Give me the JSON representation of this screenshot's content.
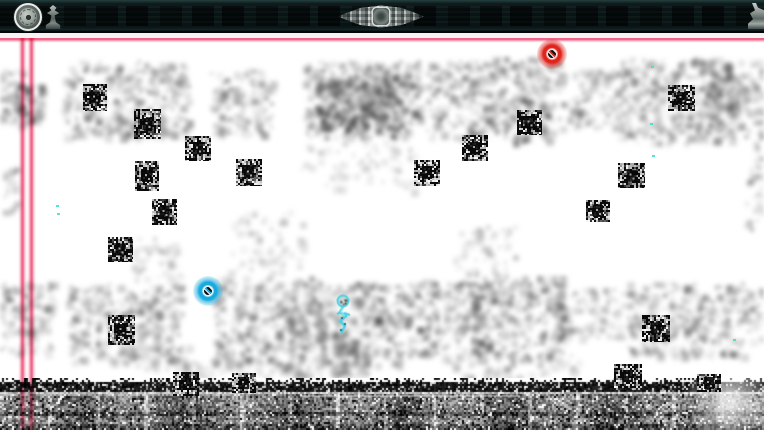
{
  "scene": {
    "kind": "glitch-platformer-level",
    "viewport": {
      "width": 764,
      "height": 430
    },
    "background_color": "#ffffff"
  },
  "hud": {
    "bar_color": "#0a1414",
    "bar_height": 33,
    "icons": [
      {
        "name": "medallion-icon"
      },
      {
        "name": "statuette-icon"
      },
      {
        "name": "center-emblem-icon"
      },
      {
        "name": "right-ornament-icon"
      }
    ]
  },
  "scanlines": {
    "color": "#ee6387",
    "horizontal": {
      "y": 34
    },
    "verticals": [
      {
        "x": 18
      },
      {
        "x": 27
      }
    ]
  },
  "entities": {
    "player": {
      "name": "player-character",
      "x": 331,
      "y": 292,
      "w": 24,
      "h": 44,
      "color": "#4ad0e0"
    },
    "orbs": [
      {
        "name": "red-orb",
        "cx": 552,
        "cy": 54,
        "color": "#e0241c",
        "lite": "#f8d8d4"
      },
      {
        "name": "cyan-orb",
        "cx": 208,
        "cy": 291,
        "color": "#18aadf",
        "lite": "#d8f2fa"
      }
    ],
    "particles": {
      "color": "#38dfc9",
      "points": [
        {
          "x": 651,
          "y": 66
        },
        {
          "x": 650,
          "y": 123
        },
        {
          "x": 652,
          "y": 155
        },
        {
          "x": 56,
          "y": 205
        },
        {
          "x": 57,
          "y": 213
        },
        {
          "x": 733,
          "y": 339
        }
      ]
    }
  },
  "blocks": [
    {
      "x": 83,
      "y": 84,
      "w": 24,
      "h": 27,
      "seed": 11
    },
    {
      "x": 134,
      "y": 109,
      "w": 27,
      "h": 30,
      "seed": 12
    },
    {
      "x": 185,
      "y": 136,
      "w": 26,
      "h": 25,
      "seed": 13
    },
    {
      "x": 135,
      "y": 161,
      "w": 24,
      "h": 30,
      "seed": 14
    },
    {
      "x": 152,
      "y": 199,
      "w": 25,
      "h": 26,
      "seed": 15
    },
    {
      "x": 108,
      "y": 237,
      "w": 25,
      "h": 25,
      "seed": 16
    },
    {
      "x": 236,
      "y": 159,
      "w": 26,
      "h": 27,
      "seed": 17
    },
    {
      "x": 414,
      "y": 160,
      "w": 26,
      "h": 26,
      "seed": 18
    },
    {
      "x": 462,
      "y": 135,
      "w": 26,
      "h": 26,
      "seed": 19
    },
    {
      "x": 517,
      "y": 110,
      "w": 25,
      "h": 25,
      "seed": 20
    },
    {
      "x": 668,
      "y": 85,
      "w": 27,
      "h": 26,
      "seed": 21
    },
    {
      "x": 618,
      "y": 163,
      "w": 27,
      "h": 25,
      "seed": 22
    },
    {
      "x": 586,
      "y": 200,
      "w": 24,
      "h": 22,
      "seed": 23
    },
    {
      "x": 108,
      "y": 315,
      "w": 27,
      "h": 30,
      "seed": 24
    },
    {
      "x": 642,
      "y": 315,
      "w": 28,
      "h": 27,
      "seed": 25
    },
    {
      "x": 173,
      "y": 372,
      "w": 26,
      "h": 24,
      "seed": 26
    },
    {
      "x": 232,
      "y": 373,
      "w": 24,
      "h": 20,
      "seed": 27
    },
    {
      "x": 614,
      "y": 364,
      "w": 28,
      "h": 24,
      "seed": 28
    },
    {
      "x": 697,
      "y": 374,
      "w": 24,
      "h": 18,
      "seed": 29
    }
  ],
  "smoke": [
    {
      "x": 0,
      "y": 68,
      "w": 28,
      "h": 55,
      "d": 0.45
    },
    {
      "x": 14,
      "y": 84,
      "w": 30,
      "h": 40,
      "d": 0.7
    },
    {
      "x": 62,
      "y": 62,
      "w": 125,
      "h": 75,
      "d": 0.5
    },
    {
      "x": 92,
      "y": 118,
      "w": 60,
      "h": 20,
      "d": 0.35
    },
    {
      "x": 212,
      "y": 70,
      "w": 60,
      "h": 65,
      "d": 0.45
    },
    {
      "x": 305,
      "y": 62,
      "w": 115,
      "h": 75,
      "d": 0.62
    },
    {
      "x": 320,
      "y": 74,
      "w": 80,
      "h": 55,
      "d": 0.85
    },
    {
      "x": 428,
      "y": 62,
      "w": 60,
      "h": 75,
      "d": 0.5
    },
    {
      "x": 488,
      "y": 58,
      "w": 75,
      "h": 85,
      "d": 0.55
    },
    {
      "x": 565,
      "y": 68,
      "w": 60,
      "h": 60,
      "d": 0.4
    },
    {
      "x": 620,
      "y": 58,
      "w": 115,
      "h": 85,
      "d": 0.5
    },
    {
      "x": 700,
      "y": 60,
      "w": 64,
      "h": 70,
      "d": 0.45
    },
    {
      "x": 744,
      "y": 130,
      "w": 20,
      "h": 100,
      "d": 0.28
    },
    {
      "x": 0,
      "y": 165,
      "w": 18,
      "h": 50,
      "d": 0.28
    },
    {
      "x": 300,
      "y": 140,
      "w": 120,
      "h": 50,
      "d": 0.14
    },
    {
      "x": 228,
      "y": 212,
      "w": 75,
      "h": 60,
      "d": 0.18
    },
    {
      "x": 455,
      "y": 225,
      "w": 60,
      "h": 80,
      "d": 0.22
    },
    {
      "x": 133,
      "y": 238,
      "w": 45,
      "h": 42,
      "d": 0.3
    },
    {
      "x": 0,
      "y": 282,
      "w": 55,
      "h": 70,
      "d": 0.45
    },
    {
      "x": 68,
      "y": 282,
      "w": 115,
      "h": 80,
      "d": 0.5
    },
    {
      "x": 128,
      "y": 345,
      "w": 60,
      "h": 25,
      "d": 0.32
    },
    {
      "x": 213,
      "y": 278,
      "w": 110,
      "h": 88,
      "d": 0.5
    },
    {
      "x": 320,
      "y": 282,
      "w": 85,
      "h": 85,
      "d": 0.55
    },
    {
      "x": 330,
      "y": 330,
      "w": 40,
      "h": 48,
      "d": 0.5
    },
    {
      "x": 288,
      "y": 295,
      "w": 35,
      "h": 85,
      "d": 0.42
    },
    {
      "x": 405,
      "y": 280,
      "w": 70,
      "h": 75,
      "d": 0.5
    },
    {
      "x": 470,
      "y": 276,
      "w": 95,
      "h": 85,
      "d": 0.55
    },
    {
      "x": 558,
      "y": 288,
      "w": 65,
      "h": 50,
      "d": 0.35
    },
    {
      "x": 628,
      "y": 282,
      "w": 115,
      "h": 75,
      "d": 0.5
    },
    {
      "x": 740,
      "y": 288,
      "w": 24,
      "h": 55,
      "d": 0.35
    },
    {
      "x": 180,
      "y": 360,
      "w": 120,
      "h": 18,
      "d": 0.28
    },
    {
      "x": 440,
      "y": 355,
      "w": 140,
      "h": 22,
      "d": 0.28
    }
  ],
  "ground": {
    "y": 378,
    "h": 52,
    "seed": 77
  }
}
